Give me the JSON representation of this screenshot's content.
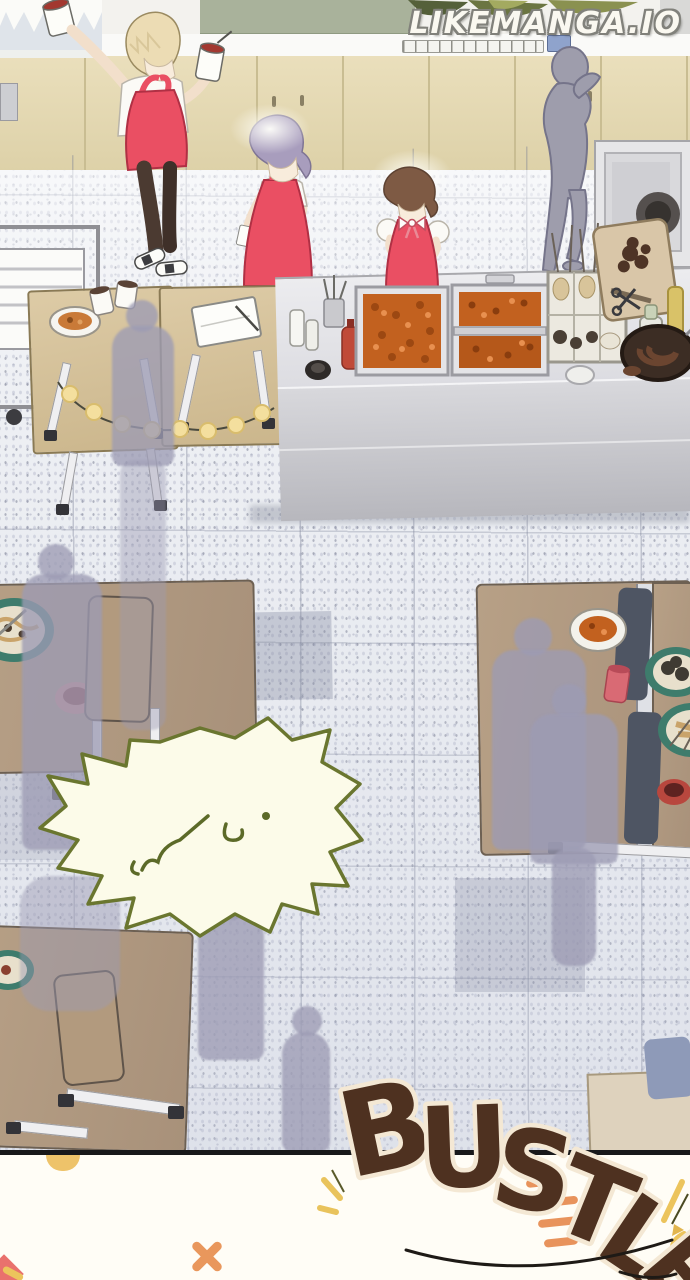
{
  "watermark": {
    "text": "LIKEMANGA.IO"
  },
  "sfx": {
    "word": "BUSTLE",
    "letters": [
      "B",
      "U",
      "S",
      "T",
      "L",
      "E"
    ]
  },
  "speech_bubble": {
    "shape": "spiky",
    "text": ""
  },
  "palette": {
    "apron_red": "#ea4f63",
    "food_orange": "#c2611f",
    "dining_table_wood": "#b7a086",
    "prep_table_wood": "#d6c3a0",
    "floor_base": "#eef0f4",
    "silhouette_grey": "#9d9cb4",
    "cabinet_tan": "#e6dbb6",
    "counter_steel": "#cfcfd4",
    "sfx_brown_dark": "#53341f",
    "sfx_brown_light": "#c97a4c",
    "sfx_outline_cream": "#f4e8d4",
    "bubble_fill": "#fcfbe9",
    "bubble_outline": "#6a762f",
    "accent_orange": "#e9975c",
    "accent_yellow": "#ecc45c"
  }
}
